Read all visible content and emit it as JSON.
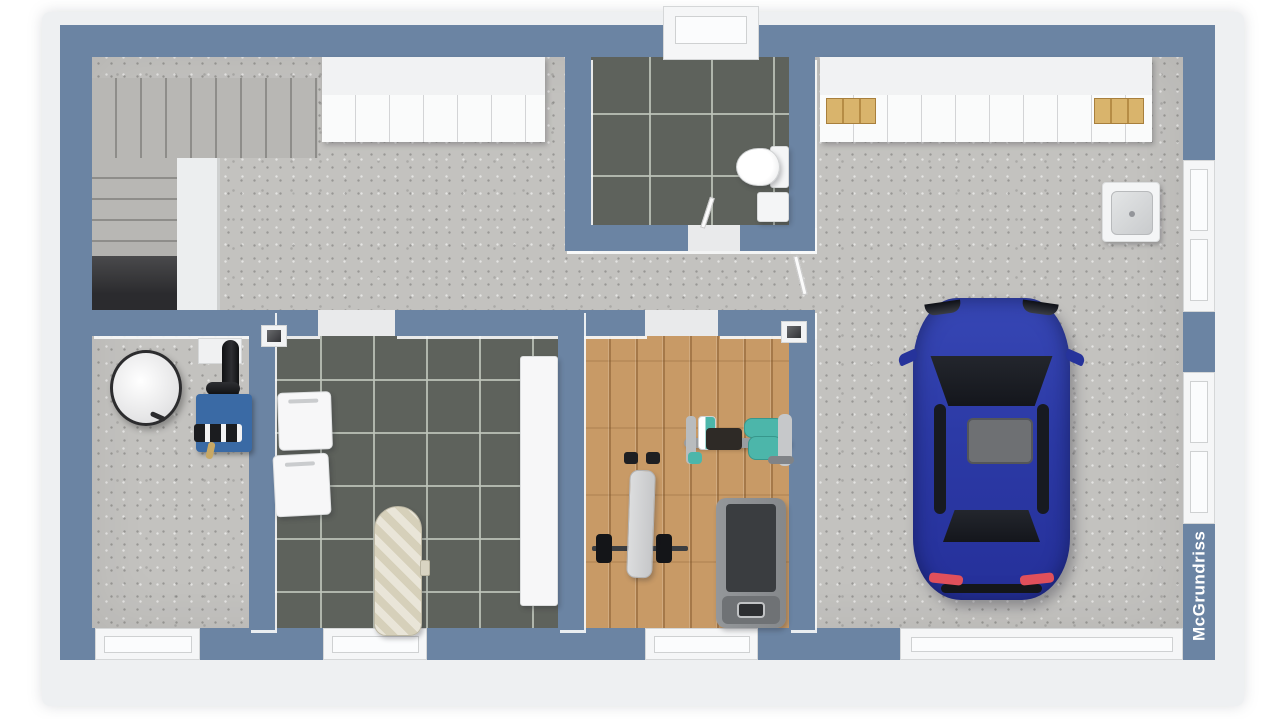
{
  "watermark": {
    "label": "McGrundriss"
  },
  "palette": {
    "wall": "#6b84a3",
    "rim": "#eef0f2",
    "concrete": "#c3c2bf",
    "tile": "#5e625c",
    "wood": "#c89a66",
    "void": "#2b2b2e",
    "opening": "#f5f6f7",
    "car-blue": "#2c3aa6",
    "car-glass": "#14161c",
    "sunroof": "#6e7073",
    "taillight": "#e0505b",
    "teal": "#4cb6aa",
    "furnace-blue": "#3a6aa5",
    "crate": "#d9b46c",
    "appliance": "#f7f7f8",
    "stair": "#b8b7b4"
  },
  "scene": {
    "type": "3d-floor-plan-render",
    "rooms": [
      {
        "name": "hall-with-staircase",
        "floor": "concrete",
        "objects": [
          "l-shaped-concrete-staircase",
          "understair-opening",
          "white-wardrobe-cabinets"
        ]
      },
      {
        "name": "bathroom",
        "floor": "dark-gray-tile",
        "objects": [
          "toilet",
          "vanity-cabinet",
          "window"
        ]
      },
      {
        "name": "garage",
        "floor": "concrete",
        "objects": [
          "blue-car",
          "storage-cabinets",
          "wooden-crates",
          "utility-sink",
          "two-glazed-doors",
          "garage-door-opening"
        ]
      },
      {
        "name": "utility-room",
        "floor": "concrete",
        "objects": [
          "white-water-tank",
          "blue-boiler-with-black-flue-pipes",
          "valves",
          "brass-pipe"
        ]
      },
      {
        "name": "laundry-room",
        "floor": "dark-gray-tile",
        "objects": [
          "washing-machine",
          "dryer",
          "ironing-board",
          "white-counter"
        ]
      },
      {
        "name": "fitness-room",
        "floor": "wood-parquet",
        "objects": [
          "weight-bench-with-barbell",
          "exercise-machine-teal",
          "treadmill"
        ]
      }
    ]
  }
}
